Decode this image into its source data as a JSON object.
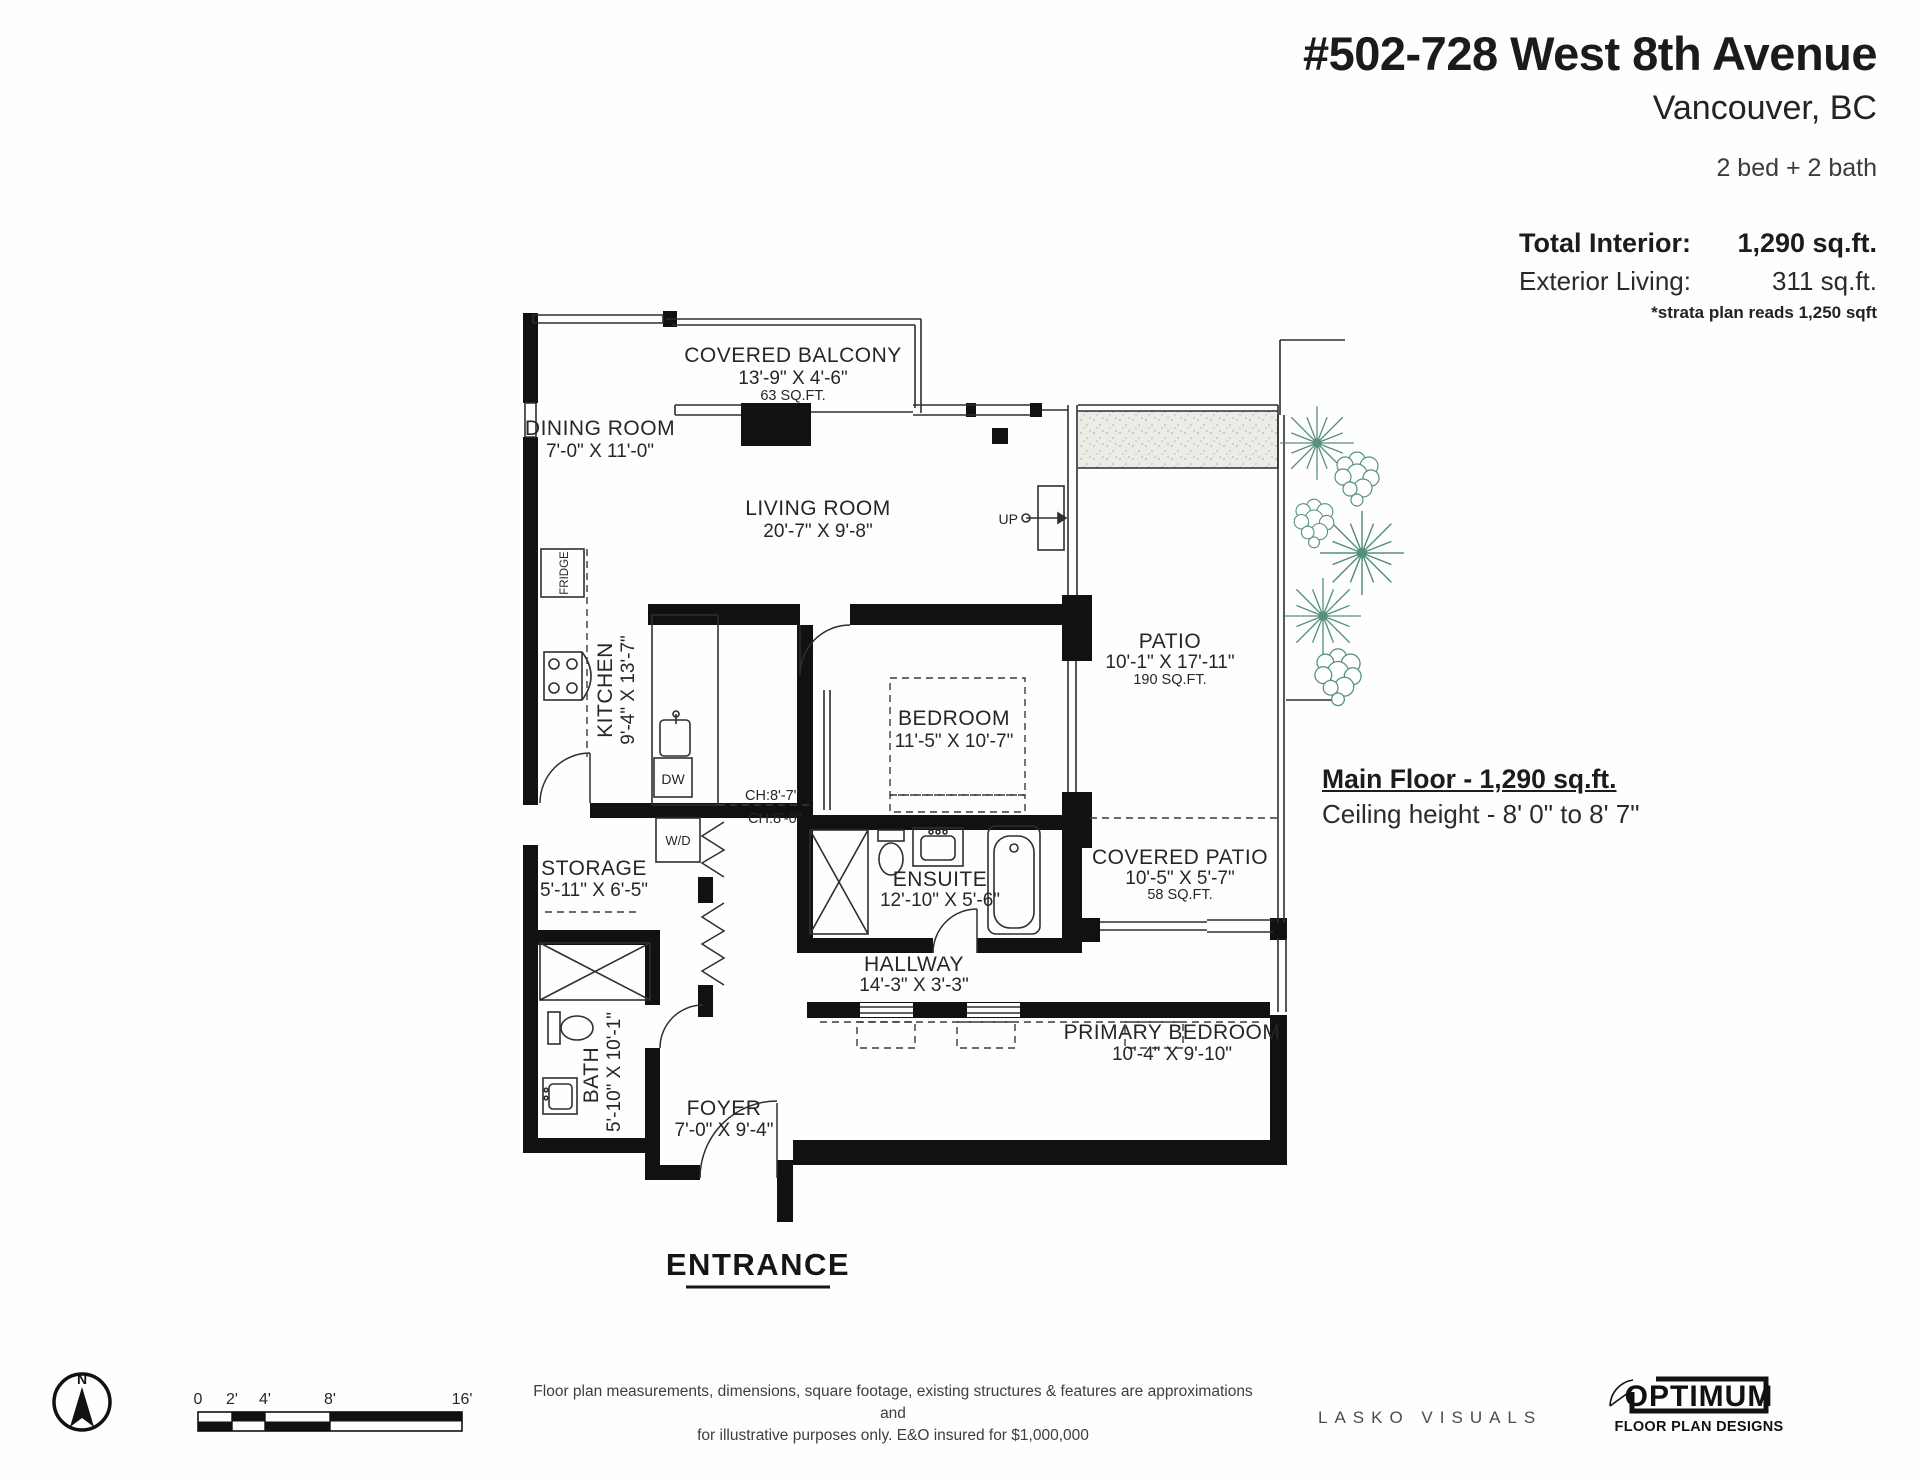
{
  "header": {
    "address": "#502-728 West 8th Avenue",
    "city": "Vancouver, BC",
    "beds_baths": "2 bed + 2 bath",
    "total_interior_label": "Total Interior:",
    "total_interior_value": "1,290 sq.ft.",
    "exterior_living_label": "Exterior Living:",
    "exterior_living_value": "311 sq.ft.",
    "strata_note": "*strata plan reads 1,250 sqft"
  },
  "plan": {
    "note_title": "Main Floor - 1,290 sq.ft.",
    "note_ceiling": "Ceiling height - 8' 0\" to 8' 7\"",
    "rooms": {
      "covered_balcony": {
        "name": "COVERED BALCONY",
        "dims": "13'-9\" X 4'-6\"",
        "area": "63 SQ.FT."
      },
      "dining": {
        "name": "DINING ROOM",
        "dims": "7'-0\" X 11'-0\""
      },
      "living": {
        "name": "LIVING ROOM",
        "dims": "20'-7\" X 9'-8\""
      },
      "kitchen": {
        "name": "KITCHEN",
        "dims": "9'-4\" X 13'-7\""
      },
      "bedroom": {
        "name": "BEDROOM",
        "dims": "11'-5\" X 10'-7\""
      },
      "patio": {
        "name": "PATIO",
        "dims": "10'-1\" X 17'-11\"",
        "area": "190 SQ.FT."
      },
      "storage": {
        "name": "STORAGE",
        "dims": "5'-11\" X 6'-5\""
      },
      "ensuite": {
        "name": "ENSUITE",
        "dims": "12'-10\" X 5'-6\""
      },
      "hallway": {
        "name": "HALLWAY",
        "dims": "14'-3\" X 3'-3\""
      },
      "covered_patio": {
        "name": "COVERED PATIO",
        "dims": "10'-5\" X 5'-7\"",
        "area": "58 SQ.FT."
      },
      "bath": {
        "name": "BATH",
        "dims": "5'-10\" X 10'-1\""
      },
      "foyer": {
        "name": "FOYER",
        "dims": "7'-0\" X 9'-4\""
      },
      "primary_bedroom": {
        "name": "PRIMARY BEDROOM",
        "dims": "10'-4\" X 9'-10\""
      }
    },
    "fixtures": {
      "fridge": "FRIDGE",
      "dishwasher": "DW",
      "washer_dryer": "W/D",
      "stairs": "UP",
      "ch_upper": "CH:8'-7\"",
      "ch_lower": "CH:8'-0\"",
      "entrance": "ENTRANCE"
    }
  },
  "footer": {
    "compass_label": "N",
    "scale_ticks": [
      "0",
      "2'",
      "4'",
      "8'",
      "16'"
    ],
    "disclaimer_line1": "Floor plan measurements, dimensions, square footage, existing structures & features are approximations and",
    "disclaimer_line2": "for illustrative purposes only.  E&O insured for $1,000,000",
    "credit": "LASKO VISUALS",
    "logo_title": "OPTIMUM",
    "logo_subtitle": "FLOOR PLAN DESIGNS"
  },
  "colors": {
    "wall": "#111111",
    "plant_green": "#55907a",
    "footer_bg": "#e3e3e2",
    "stipple_bg": "#ecece6"
  }
}
